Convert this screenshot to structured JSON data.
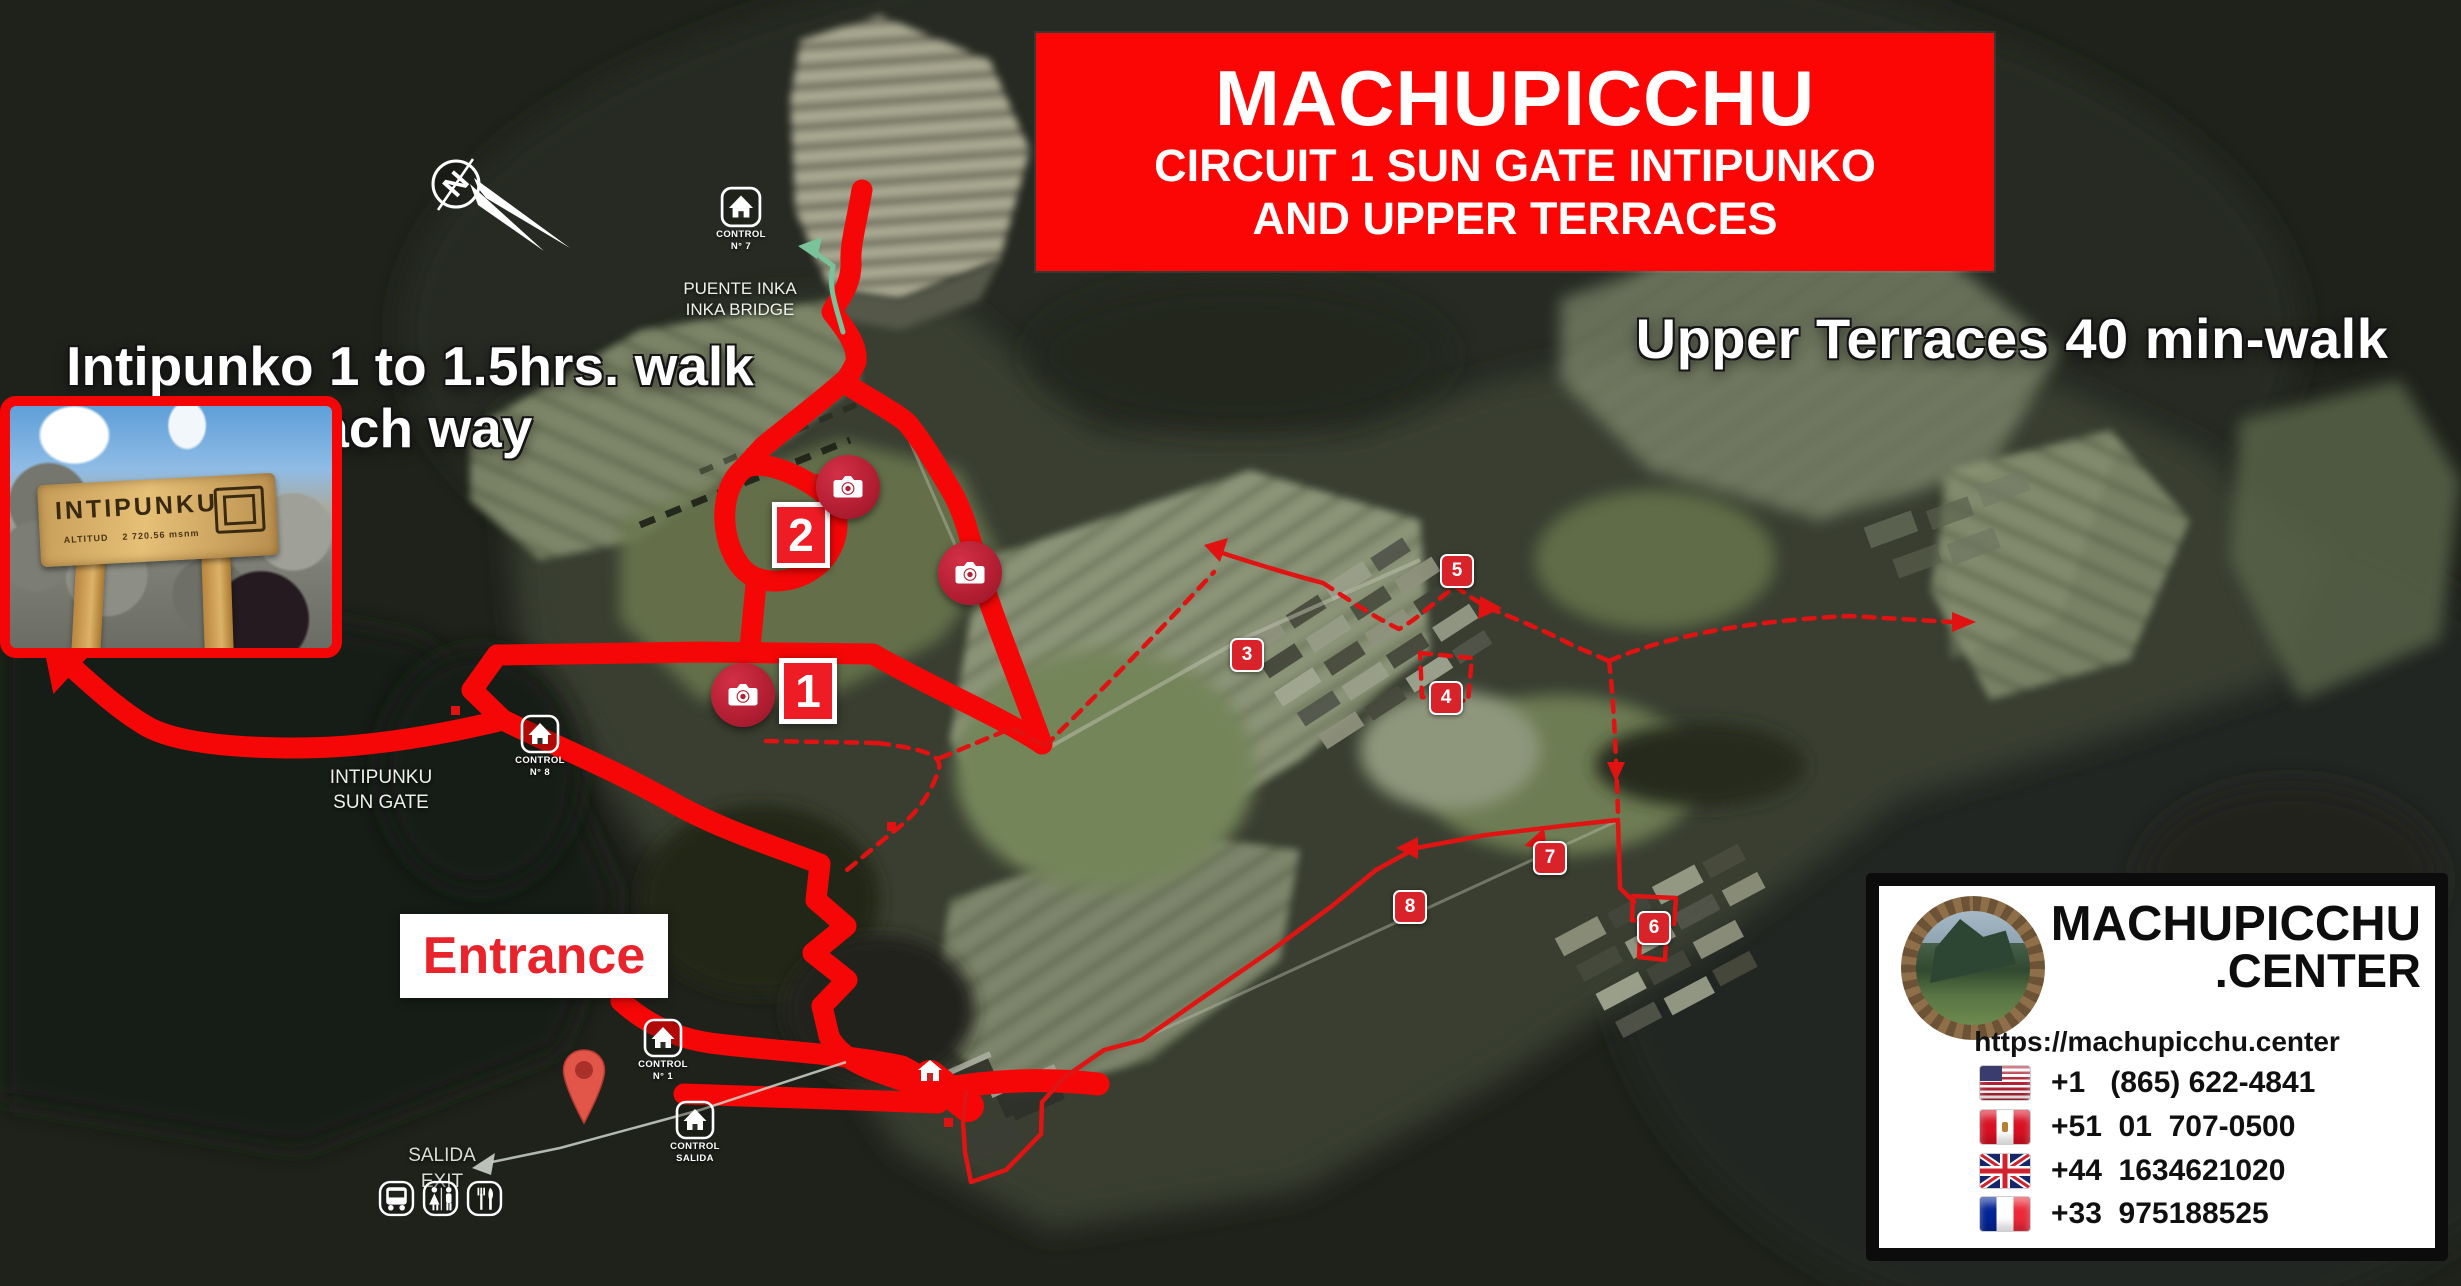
{
  "banner": {
    "line1": "MACHUPICCHU",
    "line2": "CIRCUIT 1 SUN GATE INTIPUNKO",
    "line3": "AND UPPER TERRACES"
  },
  "overlay_notes": {
    "intipunko_line1": "Intipunko 1 to 1.5hrs. walk",
    "intipunko_line2": "each way",
    "upper_terraces": "Upper Terraces 40 min-walk",
    "entrance": "Entrance"
  },
  "inset_photo": {
    "sign_title": "INTIPUNKU",
    "sign_caption_label": "ALTITUD",
    "sign_caption_value": "2 720.56 msnm"
  },
  "compass": {
    "north": "N"
  },
  "map_labels": {
    "inka_bridge": {
      "control_line1": "CONTROL",
      "control_line2": "N° 7",
      "name_line1": "PUENTE INKA",
      "name_line2": "INKA BRIDGE"
    },
    "sun_gate": {
      "control_line1": "CONTROL",
      "control_line2": "N° 8",
      "name_line1": "INTIPUNKU",
      "name_line2": "SUN GATE"
    },
    "entrance_control": {
      "control_line1": "CONTROL",
      "control_line2": "N° 1"
    },
    "exit_control": {
      "control_line1": "CONTROL",
      "control_line2": "SALIDA"
    },
    "exit": {
      "line1": "SALIDA",
      "line2": "EXIT"
    }
  },
  "waypoints": {
    "photo_stop_1": "1",
    "photo_stop_2": "2",
    "markers": [
      "3",
      "4",
      "5",
      "6",
      "7",
      "8"
    ]
  },
  "brand_card": {
    "brand_line1": "MACHUPICCHU",
    "brand_line2": ".CENTER",
    "url": "https://machupicchu.center",
    "phones": [
      {
        "country": "USA",
        "number": "+1   (865) 622-4841"
      },
      {
        "country": "Peru",
        "number": "+51  01  707-0500"
      },
      {
        "country": "UK",
        "number": "+44  1634621020"
      },
      {
        "country": "France",
        "number": "+33  975188525"
      }
    ]
  },
  "colors": {
    "route_red": "#f50707",
    "banner_red": "#fb0505",
    "marker_red": "#d8232a",
    "camera_red": "#b51f33",
    "badge_red": "#ee1c24",
    "trail_green": "#79c29a",
    "exit_grey": "#ccd3c8"
  }
}
